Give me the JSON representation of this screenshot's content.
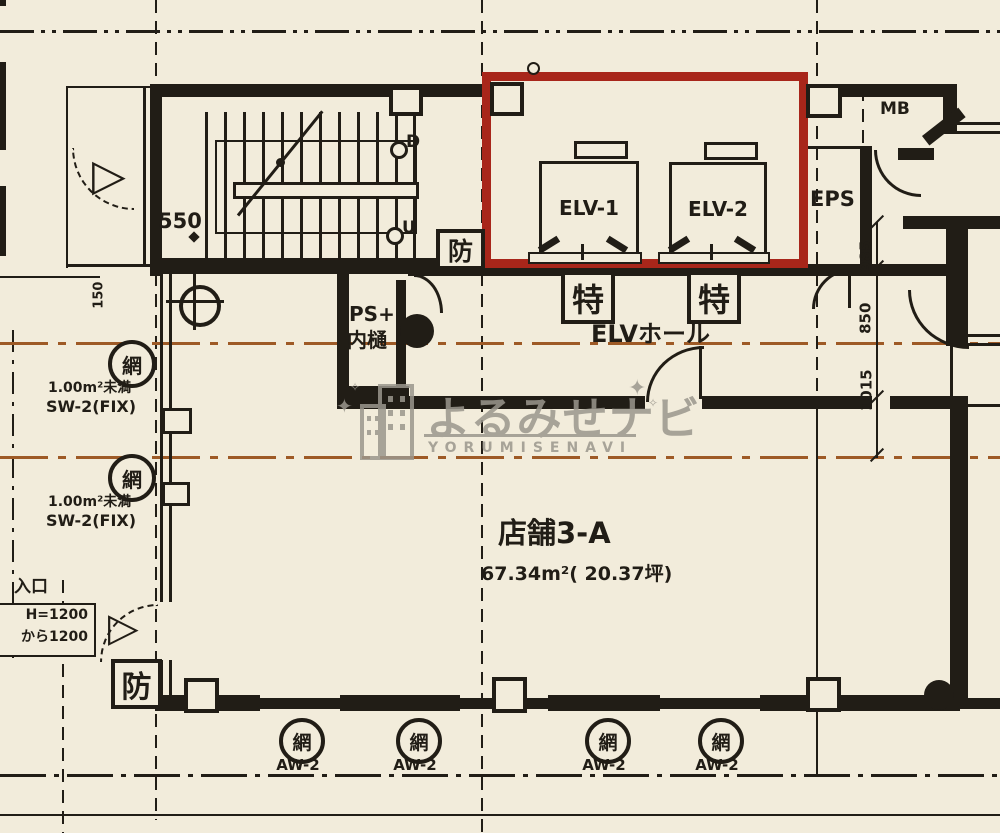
{
  "watermark": {
    "title": "よるみせナビ",
    "subtitle": "YORUMISENAVI",
    "sparkle": "✦",
    "sparkle_small": "✧"
  },
  "rooms": {
    "shop_name": "店舗3-A",
    "shop_area": "67.34m²( 20.37坪)",
    "elv_hall": "ELVホール",
    "elv1": "ELV-1",
    "elv2": "ELV-2",
    "eps": "EPS",
    "mb": "MB",
    "ps_line1": "PS+",
    "ps_line2": "内樋"
  },
  "stairs": {
    "down": "D",
    "up": "U"
  },
  "marks": {
    "fire": "防",
    "special": "特",
    "mesh": "網",
    "exit_triangle": "▷"
  },
  "dims": {
    "d550": "550",
    "d150": "150",
    "d985": "985",
    "d850": "850",
    "d1015": "1015"
  },
  "windows": {
    "sw_note1": "1.00m²未満",
    "sw_note2": "SW-2(FIX)",
    "aw_label": "AW-2"
  },
  "entrance": {
    "line0": "入口",
    "line1": "H=1200",
    "line2": "から1200"
  },
  "colors": {
    "paper": "#f2ecdb",
    "ink": "#211d16",
    "red_outline": "#a8261a",
    "center_line_orange": "#9e5a26",
    "watermark_gray": "#9b978d"
  }
}
